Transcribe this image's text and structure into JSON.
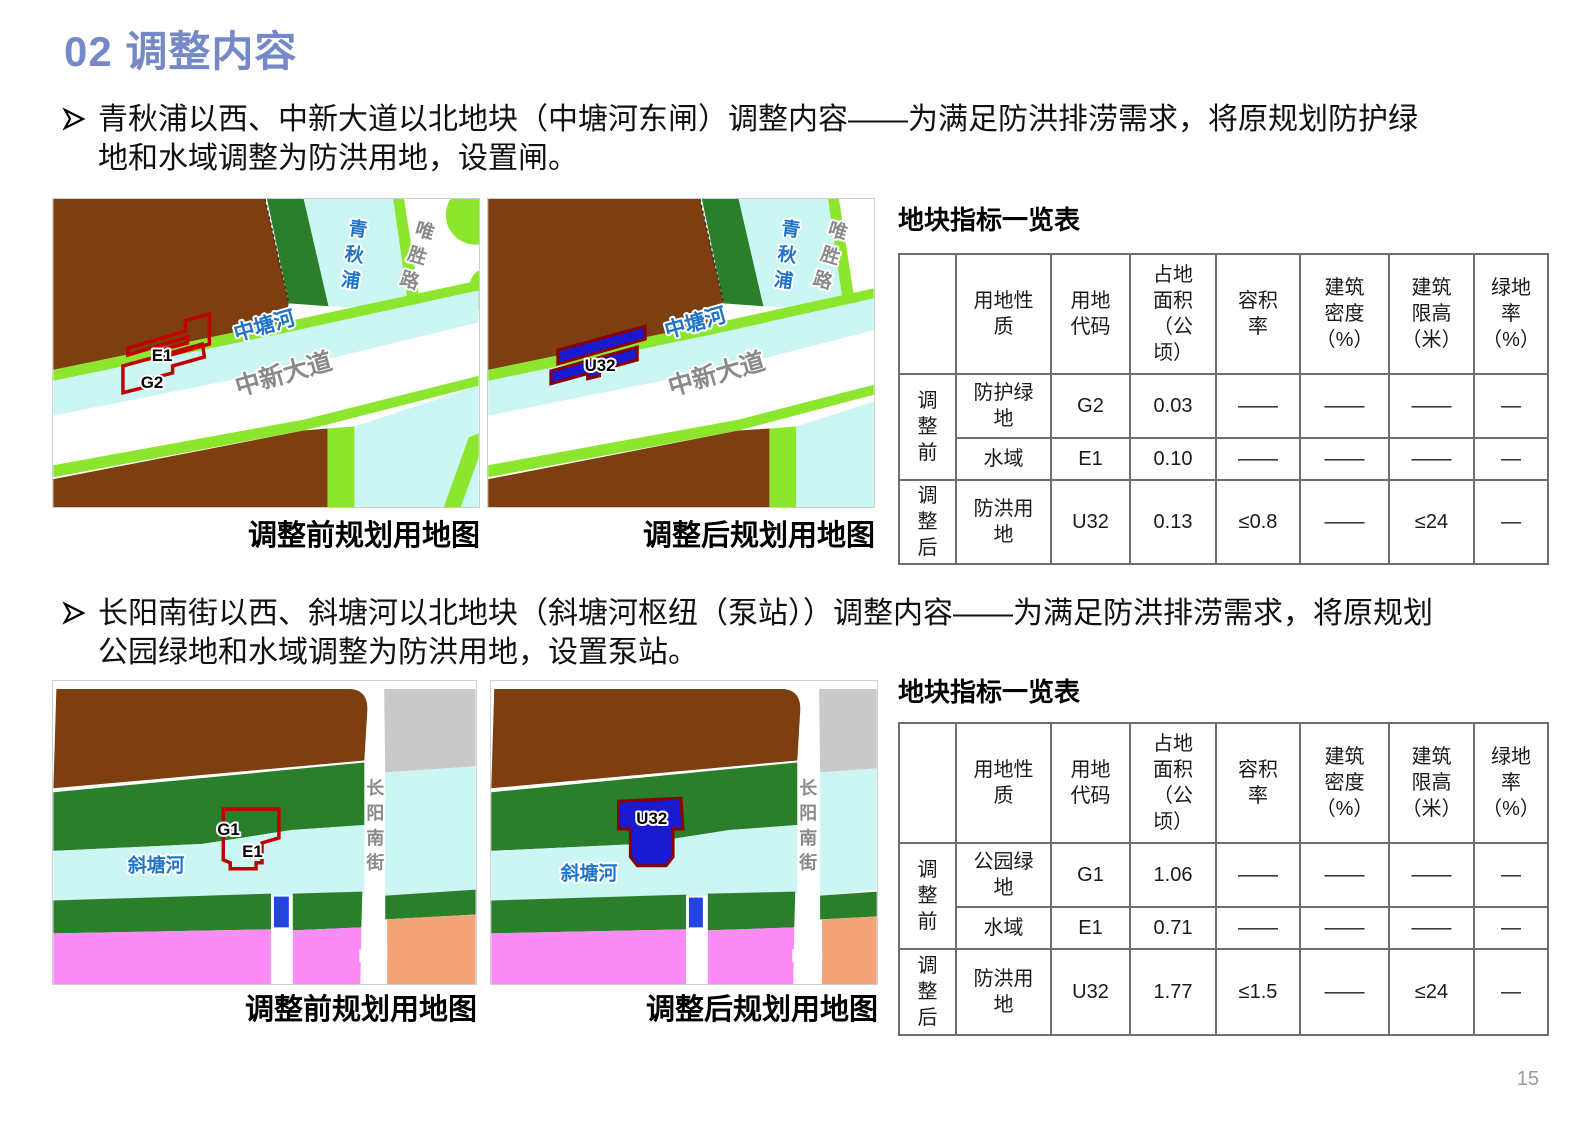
{
  "page": {
    "title": "02 调整内容",
    "page_number": "15"
  },
  "colors": {
    "title_accent": "#7589C8",
    "water_cyan": "#CBF6F4",
    "park_dark_green": "#2B7F2B",
    "protective_bright_green": "#8CE62E",
    "land_brown": "#7D3F10",
    "flood_control_blue": "#1A1AD0",
    "parcel_outline_red": "#C00000",
    "residential_pink": "#FB8CF5",
    "block_orange": "#F2A478",
    "block_gray": "#C9C9C9"
  },
  "captions": {
    "before": "调整前规划用地图",
    "after": "调整后规划用地图"
  },
  "table": {
    "title": "地块指标一览表",
    "headers": {
      "h1": "用地性\n质",
      "h2": "用地\n代码",
      "h3": "占地\n面积\n（公\n顷）",
      "h4": "容积\n率",
      "h5": "建筑\n密度\n（%）",
      "h6": "建筑\n限高\n（米）",
      "h7": "绿地\n率\n（%）"
    }
  },
  "s1": {
    "bullet": "青秋浦以西、中新大道以北地块（中塘河东闸）调整内容——为满足防洪排涝需求，将原规划防护绿地和水域调整为防洪用地，设置闸。",
    "labels": {
      "river_v": "青秋浦",
      "road_v": "唯胜路",
      "river_d": "中塘河",
      "road_d": "中新大道",
      "p_e1": "E1",
      "p_g2": "G2",
      "p_u32": "U32"
    },
    "rows": [
      {
        "group": "调\n整\n前",
        "use": "防护绿\n地",
        "code": "G2",
        "area": "0.03",
        "far": "——",
        "density": "——",
        "limit": "——",
        "green": "—"
      },
      {
        "use": "水域",
        "code": "E1",
        "area": "0.10",
        "far": "——",
        "density": "——",
        "limit": "——",
        "green": "—"
      },
      {
        "group": "调\n整\n后",
        "use": "防洪用\n地",
        "code": "U32",
        "area": "0.13",
        "far": "≤0.8",
        "density": "——",
        "limit": "≤24",
        "green": "—"
      }
    ]
  },
  "s2": {
    "bullet": "长阳南街以西、斜塘河以北地块（斜塘河枢纽（泵站））调整内容——为满足防洪排涝需求，将原规划公园绿地和水域调整为防洪用地，设置泵站。",
    "labels": {
      "river": "斜塘河",
      "road_v": "长阳南街",
      "p_g1": "G1",
      "p_e1": "E1",
      "p_u32": "U32"
    },
    "rows": [
      {
        "group": "调\n整\n前",
        "use": "公园绿\n地",
        "code": "G1",
        "area": "1.06",
        "far": "——",
        "density": "——",
        "limit": "——",
        "green": "—"
      },
      {
        "use": "水域",
        "code": "E1",
        "area": "0.71",
        "far": "——",
        "density": "——",
        "limit": "——",
        "green": "—"
      },
      {
        "group": "调\n整\n后",
        "use": "防洪用\n地",
        "code": "U32",
        "area": "1.77",
        "far": "≤1.5",
        "density": "——",
        "limit": "≤24",
        "green": "—"
      }
    ]
  }
}
